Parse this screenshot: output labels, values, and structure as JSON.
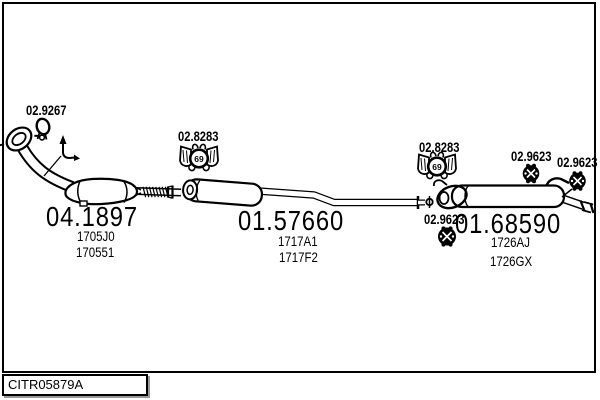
{
  "diagram_code": "CITR05879A",
  "parts": [
    {
      "id": "front-pipe-catalyst",
      "number": "04.1897",
      "refs": [
        "1705J0",
        "170551"
      ]
    },
    {
      "id": "middle-silencer",
      "number": "01.57660",
      "refs": [
        "1717A1",
        "1717F2"
      ]
    },
    {
      "id": "rear-silencer",
      "number": "01.68590",
      "refs": [
        "1726AJ",
        "1726GX"
      ]
    }
  ],
  "fittings": {
    "front_clamp": "02.9267",
    "middle_mount": "02.8283",
    "rear_mount": "02.8283",
    "rear_clamp_top_inner": "02.9623",
    "rear_clamp_top_outer": "02.9623",
    "rear_clamp_bottom": "02.9623",
    "mount_diameter": "69"
  },
  "colors": {
    "line": "#000000",
    "background": "#ffffff",
    "shadow": "#999999"
  }
}
